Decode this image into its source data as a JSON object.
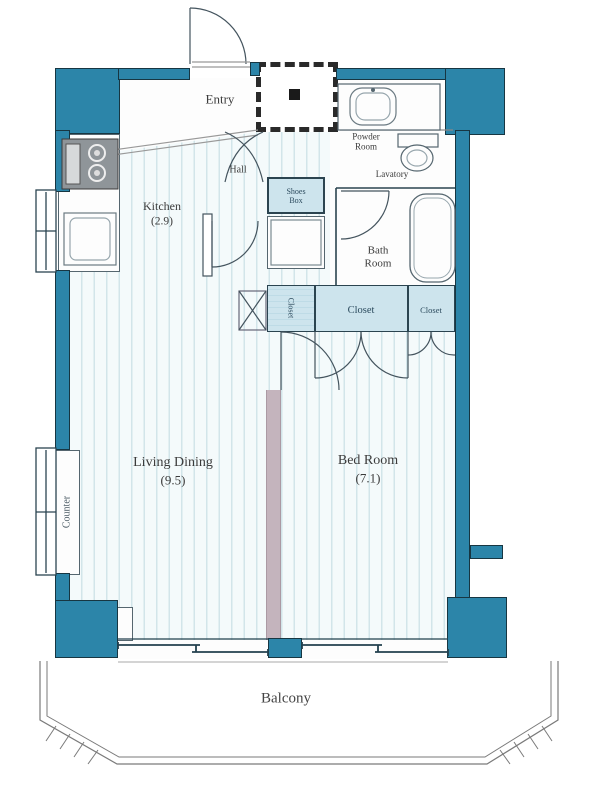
{
  "floorplan": {
    "rooms": {
      "entry": "Entry",
      "hall": "Hall",
      "kitchen": "Kitchen",
      "kitchen_size": "(2.9)",
      "powder_room": "Powder Room",
      "lavatory": "Lavatory",
      "shoes_box": "Shoes Box",
      "bath_room": "Bath Room",
      "closet_small": "Closet",
      "closet_mid": "Closet",
      "closet_right": "Closet",
      "living_dining": "Living Dining",
      "living_dining_size": "(9.5)",
      "bed_room": "Bed Room",
      "bed_room_size": "(7.1)",
      "counter": "Counter",
      "balcony": "Balcony"
    },
    "colors": {
      "wall": "#2c85a9",
      "wall_outline": "#173642",
      "floor_base": "#f4fafb",
      "floor_stripe": "#d2e5ea",
      "closet_fill": "#cde4ed",
      "partition": "#c4b4bd",
      "linework": "#44545e",
      "text": "#3b3b3b"
    }
  }
}
